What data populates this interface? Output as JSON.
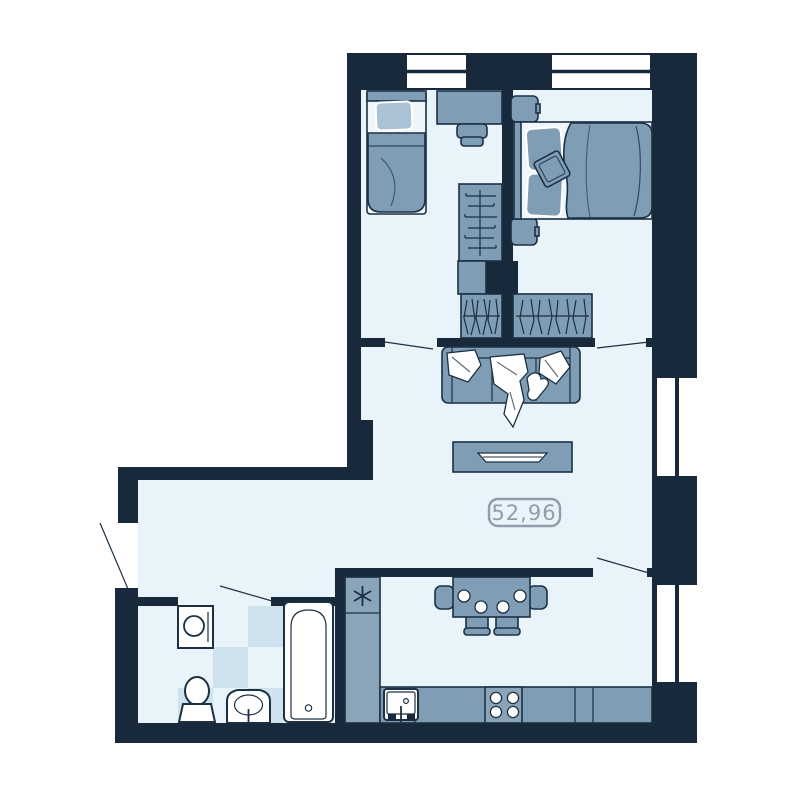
{
  "plan": {
    "area_label": "52,96",
    "palette": {
      "wall": "#17293a",
      "outline": "#1b3044",
      "floor": "#e8f4fa",
      "furniture": "#7f9db5",
      "furniture_light": "#aac2d3",
      "cabinet": "#8ba4b8",
      "tile": "#cfe3ee",
      "fixture": "#ffffff",
      "sheet": "#eef6fb",
      "label": "#8d9dab",
      "background": "#ffffff"
    },
    "icons": [
      "single-bed-icon",
      "desk-icon",
      "chair-icon",
      "wardrobe-shelves-icon",
      "closet-icon",
      "hanging-rail-wardrobe-icon",
      "double-bed-icon",
      "nightstand-icon",
      "sofa-icon",
      "tv-stand-icon",
      "plate-icon",
      "dining-table-icon",
      "snowflake-fridge-icon",
      "kitchen-sink-icon",
      "stove-burners-icon",
      "washing-machine-icon",
      "toilet-icon",
      "washbasin-icon",
      "bathtub-icon",
      "window-icon",
      "door-swing-icon"
    ],
    "counts": {
      "windows": 4,
      "door_swings": 5
    }
  }
}
